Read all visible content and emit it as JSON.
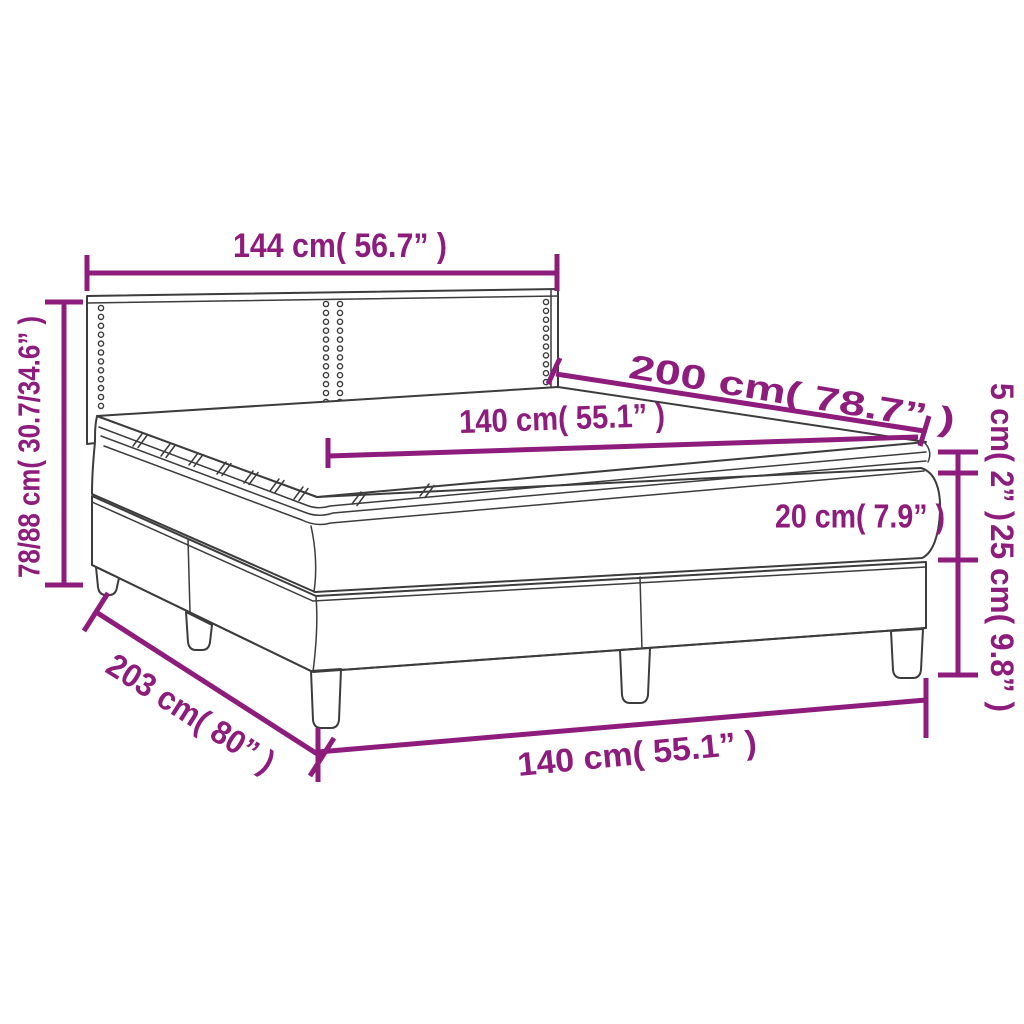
{
  "diagram": {
    "description": "Box spring bed with mattress and topper - product dimension diagram",
    "accent_color": "#8d1c7c",
    "outline_color": "#3c3c3c",
    "background_color": "#ffffff",
    "labels": {
      "headboard_width": "144 cm( 56.7” )",
      "length_top": "200 cm( 78.7” )",
      "mattress_width": "140 cm( 55.1” )",
      "height_total": "78/88 cm( 30.7/34.6” )",
      "topper_thickness": "5 cm( 2” )",
      "mattress_thickness": "20 cm( 7.9” )",
      "base_height": "25 cm( 9.8” )",
      "length_bottom": "203 cm( 80” )",
      "width_bottom": "140 cm( 55.1” )"
    }
  }
}
